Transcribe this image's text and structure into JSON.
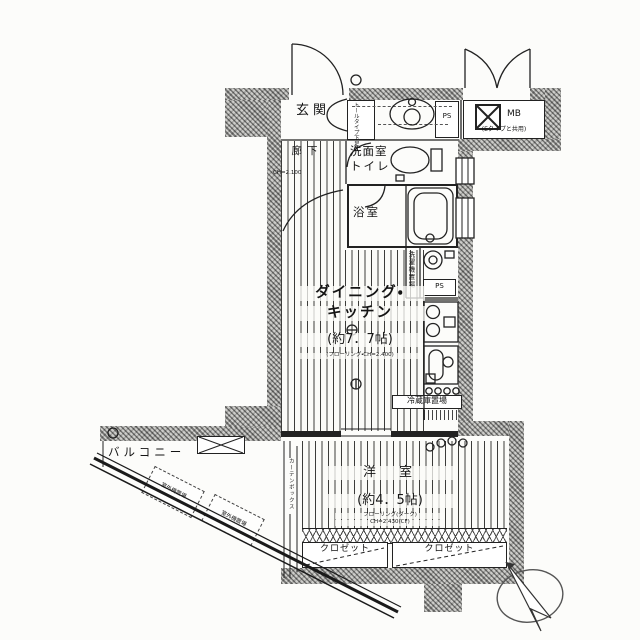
{
  "colors": {
    "paper": "#fcfcfa",
    "ink": "#1c1c1c",
    "wall_gray": "#b3b3af"
  },
  "plan": {
    "entrance": {
      "label": "玄関"
    },
    "shoe_box": {
      "label": "トールタイプ下足入"
    },
    "hallway": {
      "label": "廊下",
      "ceiling_height": "CH=2.100"
    },
    "washroom_toilet": {
      "line1": "洗面室",
      "line2": "トイレ"
    },
    "bathroom": {
      "label": "浴室"
    },
    "laundry": {
      "label": "洗濯機置場"
    },
    "pipe_space_top": {
      "label": "PS"
    },
    "pipe_space_mid": {
      "label": "PS"
    },
    "meter_box": {
      "label": "MB",
      "note": "(Eタイプと共用)"
    },
    "dining_kitchen": {
      "name_line1": "ダイニング・",
      "name_line2": "キッチン",
      "size": "(約7．7帖)",
      "note": "(フローリング・CH=2.400)"
    },
    "refrigerator": {
      "label": "冷蔵庫置場"
    },
    "western_room": {
      "label": "洋　室",
      "size": "(約4．5帖)",
      "note1": "フローリング(ダーク)",
      "note2": "CH=2.430(CF)"
    },
    "closet_left": {
      "label": "クロゼット"
    },
    "closet_right": {
      "label": "クロゼット"
    },
    "balcony": {
      "label": "バルコニー"
    },
    "outdoor_unit_1": {
      "label": "室外機置場"
    },
    "outdoor_unit_2": {
      "label": "室外機置場"
    },
    "curtain_box": {
      "label": "カーテンボックス"
    }
  }
}
